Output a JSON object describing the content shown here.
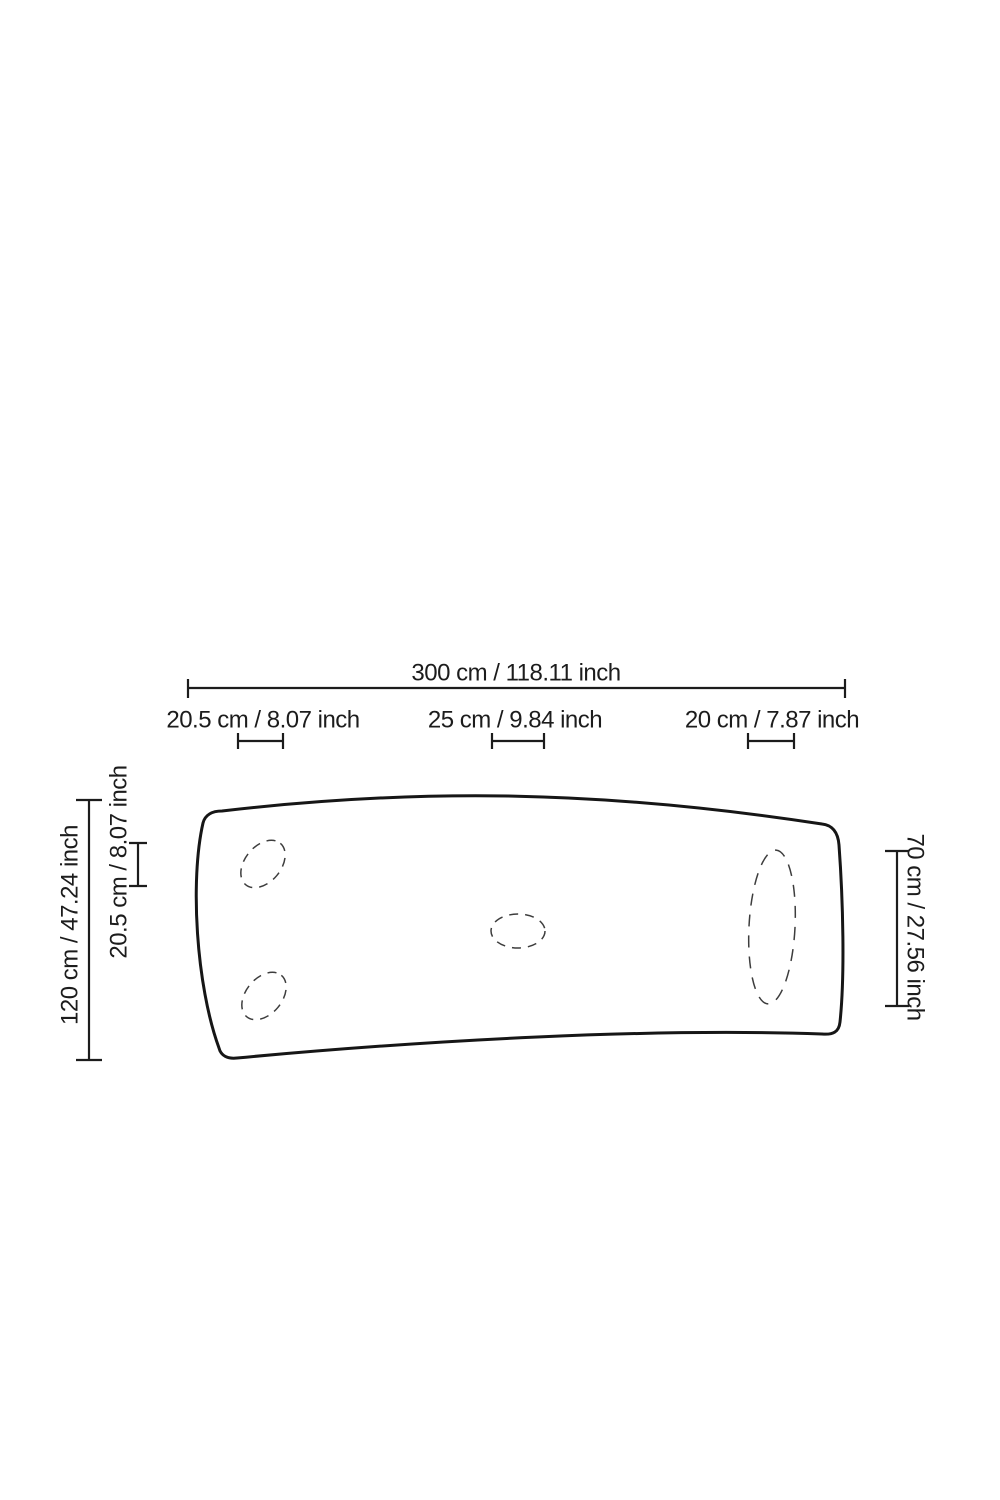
{
  "palette": {
    "background": "#ffffff",
    "line": "#1c1c1c",
    "dashed_line": "#3d3d3d"
  },
  "labels": {
    "overall_width": "300 cm / 118.11 inch",
    "foot_left_width": "20.5 cm / 8.07 inch",
    "foot_center_width": "25 cm / 9.84 inch",
    "foot_right_width": "20 cm / 7.87 inch",
    "overall_depth": "120 cm / 47.24 inch",
    "foot_left_depth": "20.5 cm / 8.07 inch",
    "foot_right_depth": "70 cm / 27.56 inch"
  }
}
